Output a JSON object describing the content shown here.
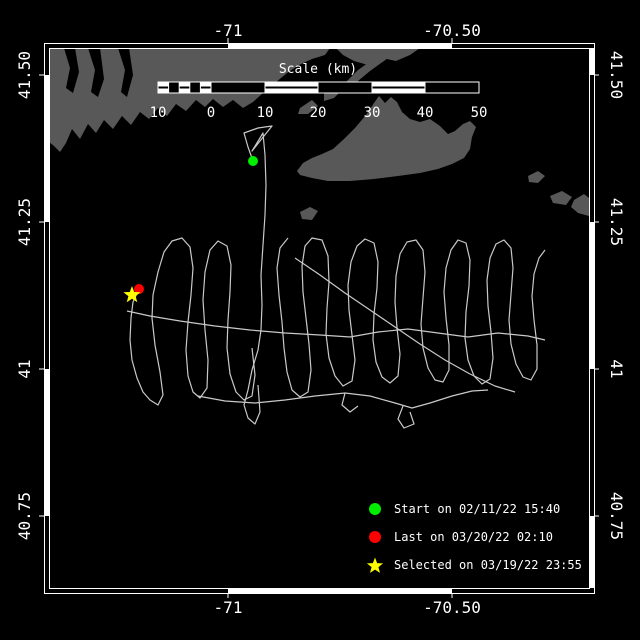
{
  "colors": {
    "background": "#000000",
    "land": "#585858",
    "track": "#c9c9c9",
    "frame": "#ffffff",
    "start_marker": "#00ee00",
    "last_marker": "#ff0000",
    "selected_marker": "#ffff00",
    "text": "#ffffff"
  },
  "axes": {
    "lon_ticks": [
      {
        "label": "-71",
        "x": 228
      },
      {
        "label": "-70.50",
        "x": 452
      }
    ],
    "lat_ticks": [
      {
        "label": "41.50",
        "y": 75
      },
      {
        "label": "41.25",
        "y": 222
      },
      {
        "label": "41",
        "y": 369
      },
      {
        "label": "40.75",
        "y": 516
      }
    ]
  },
  "frame": {
    "outer": [
      44,
      43,
      594,
      593
    ],
    "inner": [
      49,
      48,
      589,
      588
    ],
    "filled_segments": {
      "top": [
        [
          228,
          452
        ]
      ],
      "bottom": [
        [
          228,
          452
        ]
      ],
      "left": [
        [
          75,
          222
        ],
        [
          369,
          516
        ]
      ],
      "right": [
        [
          48,
          75
        ],
        [
          222,
          369
        ],
        [
          516,
          588
        ]
      ]
    }
  },
  "scalebar": {
    "title": "Scale (km)",
    "x0": 158,
    "x1": 479,
    "y": 82,
    "h": 11,
    "zero_x": 211,
    "sub_cells": 5,
    "labels": [
      {
        "t": "10",
        "x": 158
      },
      {
        "t": "0",
        "x": 211
      },
      {
        "t": "10",
        "x": 265
      },
      {
        "t": "20",
        "x": 318
      },
      {
        "t": "30",
        "x": 372
      },
      {
        "t": "40",
        "x": 425
      },
      {
        "t": "50",
        "x": 479
      }
    ],
    "labels_baseline_y": 117
  },
  "legend": {
    "items": [
      {
        "symbol": "circle",
        "color": "#00ee00",
        "label": "Start on 02/11/22 15:40"
      },
      {
        "symbol": "circle",
        "color": "#ff0000",
        "label": "Last on 03/20/22 02:10"
      },
      {
        "symbol": "star",
        "color": "#ffff00",
        "label": "Selected on 03/19/22 23:55"
      }
    ]
  },
  "markers": [
    {
      "name": "start-marker",
      "symbol": "circle",
      "color": "#00ee00",
      "x": 253,
      "y": 161,
      "r": 5
    },
    {
      "name": "last-marker",
      "symbol": "circle",
      "color": "#ff0000",
      "x": 139,
      "y": 289,
      "r": 5
    },
    {
      "name": "selected-marker",
      "symbol": "star",
      "color": "#ffff00",
      "x": 132,
      "y": 295,
      "r": 9
    }
  ],
  "land_polygons": [
    [
      [
        49,
        48
      ],
      [
        330,
        48
      ],
      [
        325,
        55
      ],
      [
        312,
        59
      ],
      [
        299,
        65
      ],
      [
        287,
        73
      ],
      [
        275,
        83
      ],
      [
        263,
        93
      ],
      [
        253,
        102
      ],
      [
        243,
        108
      ],
      [
        233,
        100
      ],
      [
        223,
        107
      ],
      [
        213,
        99
      ],
      [
        205,
        107
      ],
      [
        196,
        100
      ],
      [
        186,
        111
      ],
      [
        176,
        104
      ],
      [
        167,
        116
      ],
      [
        158,
        108
      ],
      [
        149,
        119
      ],
      [
        140,
        112
      ],
      [
        131,
        125
      ],
      [
        122,
        116
      ],
      [
        113,
        129
      ],
      [
        104,
        120
      ],
      [
        96,
        133
      ],
      [
        88,
        124
      ],
      [
        80,
        139
      ],
      [
        72,
        129
      ],
      [
        66,
        143
      ],
      [
        60,
        152
      ],
      [
        54,
        146
      ],
      [
        49,
        142
      ]
    ],
    [
      [
        336,
        48
      ],
      [
        420,
        48
      ],
      [
        410,
        55
      ],
      [
        396,
        61
      ],
      [
        382,
        58
      ],
      [
        368,
        65
      ],
      [
        354,
        61
      ],
      [
        343,
        55
      ]
    ],
    [
      [
        346,
        82
      ],
      [
        358,
        70
      ],
      [
        372,
        60
      ],
      [
        386,
        51
      ],
      [
        394,
        46
      ],
      [
        396,
        52
      ],
      [
        384,
        61
      ],
      [
        370,
        71
      ],
      [
        358,
        81
      ],
      [
        350,
        87
      ]
    ],
    [
      [
        324,
        94
      ],
      [
        336,
        84
      ],
      [
        344,
        88
      ],
      [
        334,
        98
      ],
      [
        324,
        101
      ]
    ],
    [
      [
        300,
        108
      ],
      [
        312,
        100
      ],
      [
        318,
        106
      ],
      [
        308,
        114
      ],
      [
        298,
        114
      ]
    ],
    [
      [
        297,
        171
      ],
      [
        303,
        163
      ],
      [
        312,
        158
      ],
      [
        322,
        154
      ],
      [
        333,
        149
      ],
      [
        344,
        139
      ],
      [
        355,
        128
      ],
      [
        366,
        115
      ],
      [
        374,
        103
      ],
      [
        379,
        96
      ],
      [
        385,
        103
      ],
      [
        391,
        97
      ],
      [
        397,
        102
      ],
      [
        402,
        112
      ],
      [
        410,
        119
      ],
      [
        420,
        122
      ],
      [
        430,
        119
      ],
      [
        440,
        126
      ],
      [
        448,
        134
      ],
      [
        455,
        131
      ],
      [
        463,
        124
      ],
      [
        470,
        121
      ],
      [
        476,
        127
      ],
      [
        472,
        137
      ],
      [
        470,
        149
      ],
      [
        464,
        158
      ],
      [
        452,
        164
      ],
      [
        438,
        169
      ],
      [
        420,
        173
      ],
      [
        398,
        176
      ],
      [
        374,
        179
      ],
      [
        350,
        181
      ],
      [
        328,
        181
      ],
      [
        312,
        178
      ],
      [
        300,
        175
      ]
    ],
    [
      [
        300,
        212
      ],
      [
        310,
        207
      ],
      [
        318,
        211
      ],
      [
        312,
        220
      ],
      [
        302,
        219
      ]
    ],
    [
      [
        528,
        176
      ],
      [
        538,
        171
      ],
      [
        545,
        176
      ],
      [
        538,
        183
      ],
      [
        529,
        182
      ]
    ],
    [
      [
        550,
        196
      ],
      [
        562,
        191
      ],
      [
        572,
        197
      ],
      [
        566,
        205
      ],
      [
        553,
        203
      ]
    ],
    [
      [
        574,
        200
      ],
      [
        584,
        194
      ],
      [
        589,
        198
      ],
      [
        589,
        216
      ],
      [
        578,
        213
      ],
      [
        571,
        207
      ]
    ]
  ],
  "water_cuts": [
    [
      [
        64,
        48
      ],
      [
        70,
        68
      ],
      [
        66,
        88
      ],
      [
        73,
        93
      ],
      [
        79,
        72
      ],
      [
        75,
        48
      ]
    ],
    [
      [
        88,
        48
      ],
      [
        95,
        70
      ],
      [
        91,
        92
      ],
      [
        98,
        97
      ],
      [
        104,
        79
      ],
      [
        100,
        48
      ]
    ],
    [
      [
        118,
        48
      ],
      [
        125,
        70
      ],
      [
        121,
        92
      ],
      [
        127,
        97
      ],
      [
        133,
        75
      ],
      [
        129,
        48
      ]
    ]
  ],
  "track_paths": [
    [
      [
        253,
        161
      ],
      [
        248,
        147
      ],
      [
        244,
        133
      ],
      [
        258,
        128
      ],
      [
        272,
        126
      ],
      [
        260,
        141
      ],
      [
        252,
        151
      ],
      [
        263,
        133
      ],
      [
        265,
        155
      ],
      [
        266,
        185
      ],
      [
        265,
        215
      ],
      [
        263,
        245
      ],
      [
        261,
        275
      ],
      [
        262,
        305
      ],
      [
        261,
        330
      ],
      [
        258,
        350
      ],
      [
        252,
        370
      ],
      [
        248,
        390
      ],
      [
        244,
        405
      ],
      [
        248,
        418
      ],
      [
        255,
        424
      ],
      [
        260,
        412
      ],
      [
        258,
        385
      ]
    ],
    [
      [
        138,
        291
      ],
      [
        133,
        302
      ],
      [
        131,
        318
      ],
      [
        130,
        340
      ],
      [
        132,
        360
      ],
      [
        137,
        378
      ],
      [
        143,
        392
      ],
      [
        150,
        400
      ],
      [
        158,
        405
      ],
      [
        163,
        395
      ],
      [
        160,
        372
      ],
      [
        155,
        345
      ],
      [
        152,
        318
      ],
      [
        153,
        295
      ],
      [
        158,
        272
      ],
      [
        164,
        252
      ],
      [
        172,
        241
      ],
      [
        182,
        238
      ],
      [
        190,
        247
      ],
      [
        193,
        268
      ],
      [
        191,
        295
      ],
      [
        188,
        322
      ],
      [
        186,
        350
      ],
      [
        188,
        376
      ],
      [
        193,
        392
      ],
      [
        200,
        398
      ],
      [
        207,
        388
      ],
      [
        208,
        360
      ],
      [
        205,
        330
      ],
      [
        203,
        300
      ],
      [
        205,
        272
      ],
      [
        210,
        250
      ],
      [
        218,
        241
      ],
      [
        227,
        246
      ],
      [
        231,
        265
      ],
      [
        230,
        292
      ],
      [
        228,
        320
      ],
      [
        227,
        348
      ],
      [
        230,
        374
      ],
      [
        236,
        392
      ],
      [
        244,
        400
      ],
      [
        252,
        396
      ],
      [
        255,
        375
      ],
      [
        252,
        348
      ]
    ],
    [
      [
        288,
        238
      ],
      [
        280,
        248
      ],
      [
        277,
        268
      ],
      [
        279,
        295
      ],
      [
        282,
        322
      ],
      [
        284,
        348
      ],
      [
        287,
        372
      ],
      [
        292,
        390
      ],
      [
        300,
        397
      ],
      [
        308,
        392
      ],
      [
        311,
        370
      ],
      [
        309,
        344
      ],
      [
        306,
        318
      ],
      [
        303,
        292
      ],
      [
        302,
        266
      ],
      [
        305,
        246
      ],
      [
        312,
        238
      ],
      [
        322,
        240
      ],
      [
        328,
        256
      ],
      [
        329,
        282
      ],
      [
        327,
        308
      ],
      [
        326,
        334
      ],
      [
        329,
        358
      ],
      [
        335,
        376
      ],
      [
        343,
        386
      ],
      [
        352,
        381
      ],
      [
        355,
        360
      ],
      [
        352,
        335
      ],
      [
        349,
        310
      ],
      [
        348,
        285
      ],
      [
        351,
        262
      ],
      [
        357,
        246
      ],
      [
        365,
        239
      ],
      [
        374,
        243
      ],
      [
        378,
        262
      ],
      [
        377,
        288
      ],
      [
        374,
        314
      ],
      [
        373,
        340
      ],
      [
        376,
        362
      ],
      [
        382,
        377
      ],
      [
        390,
        383
      ],
      [
        398,
        376
      ],
      [
        400,
        354
      ],
      [
        397,
        328
      ],
      [
        395,
        302
      ],
      [
        396,
        276
      ],
      [
        400,
        254
      ],
      [
        407,
        242
      ],
      [
        416,
        240
      ],
      [
        423,
        250
      ],
      [
        425,
        272
      ],
      [
        423,
        298
      ],
      [
        421,
        324
      ],
      [
        423,
        348
      ],
      [
        428,
        368
      ],
      [
        435,
        380
      ],
      [
        443,
        382
      ],
      [
        449,
        370
      ],
      [
        449,
        345
      ],
      [
        446,
        318
      ],
      [
        444,
        292
      ],
      [
        446,
        268
      ],
      [
        451,
        250
      ],
      [
        458,
        240
      ],
      [
        466,
        243
      ],
      [
        470,
        260
      ],
      [
        469,
        286
      ],
      [
        466,
        312
      ],
      [
        465,
        338
      ],
      [
        468,
        360
      ],
      [
        474,
        376
      ],
      [
        482,
        384
      ],
      [
        490,
        379
      ],
      [
        493,
        358
      ],
      [
        491,
        332
      ],
      [
        488,
        306
      ],
      [
        487,
        280
      ],
      [
        490,
        258
      ],
      [
        496,
        244
      ],
      [
        504,
        240
      ],
      [
        511,
        248
      ],
      [
        513,
        268
      ],
      [
        511,
        294
      ],
      [
        509,
        320
      ],
      [
        511,
        344
      ],
      [
        516,
        364
      ],
      [
        523,
        377
      ],
      [
        531,
        380
      ],
      [
        537,
        369
      ],
      [
        537,
        345
      ],
      [
        534,
        320
      ],
      [
        532,
        296
      ],
      [
        534,
        274
      ],
      [
        539,
        258
      ],
      [
        545,
        250
      ]
    ],
    [
      [
        127,
        311
      ],
      [
        150,
        316
      ],
      [
        180,
        321
      ],
      [
        215,
        326
      ],
      [
        250,
        330
      ],
      [
        285,
        333
      ],
      [
        320,
        335
      ],
      [
        350,
        337
      ],
      [
        378,
        332
      ],
      [
        408,
        329
      ],
      [
        438,
        333
      ],
      [
        468,
        337
      ],
      [
        498,
        333
      ],
      [
        528,
        336
      ],
      [
        545,
        340
      ]
    ],
    [
      [
        295,
        258
      ],
      [
        320,
        275
      ],
      [
        345,
        293
      ],
      [
        370,
        310
      ],
      [
        395,
        327
      ],
      [
        420,
        344
      ],
      [
        445,
        360
      ],
      [
        470,
        374
      ],
      [
        495,
        386
      ],
      [
        515,
        392
      ]
    ],
    [
      [
        198,
        396
      ],
      [
        225,
        401
      ],
      [
        255,
        403
      ],
      [
        285,
        400
      ],
      [
        315,
        396
      ],
      [
        345,
        393
      ],
      [
        370,
        396
      ],
      [
        395,
        403
      ],
      [
        412,
        408
      ],
      [
        430,
        403
      ],
      [
        452,
        396
      ],
      [
        472,
        391
      ],
      [
        488,
        390
      ]
    ],
    [
      [
        403,
        406
      ],
      [
        398,
        419
      ],
      [
        404,
        428
      ],
      [
        414,
        424
      ],
      [
        410,
        412
      ]
    ],
    [
      [
        345,
        393
      ],
      [
        342,
        405
      ],
      [
        350,
        412
      ],
      [
        358,
        406
      ]
    ]
  ]
}
